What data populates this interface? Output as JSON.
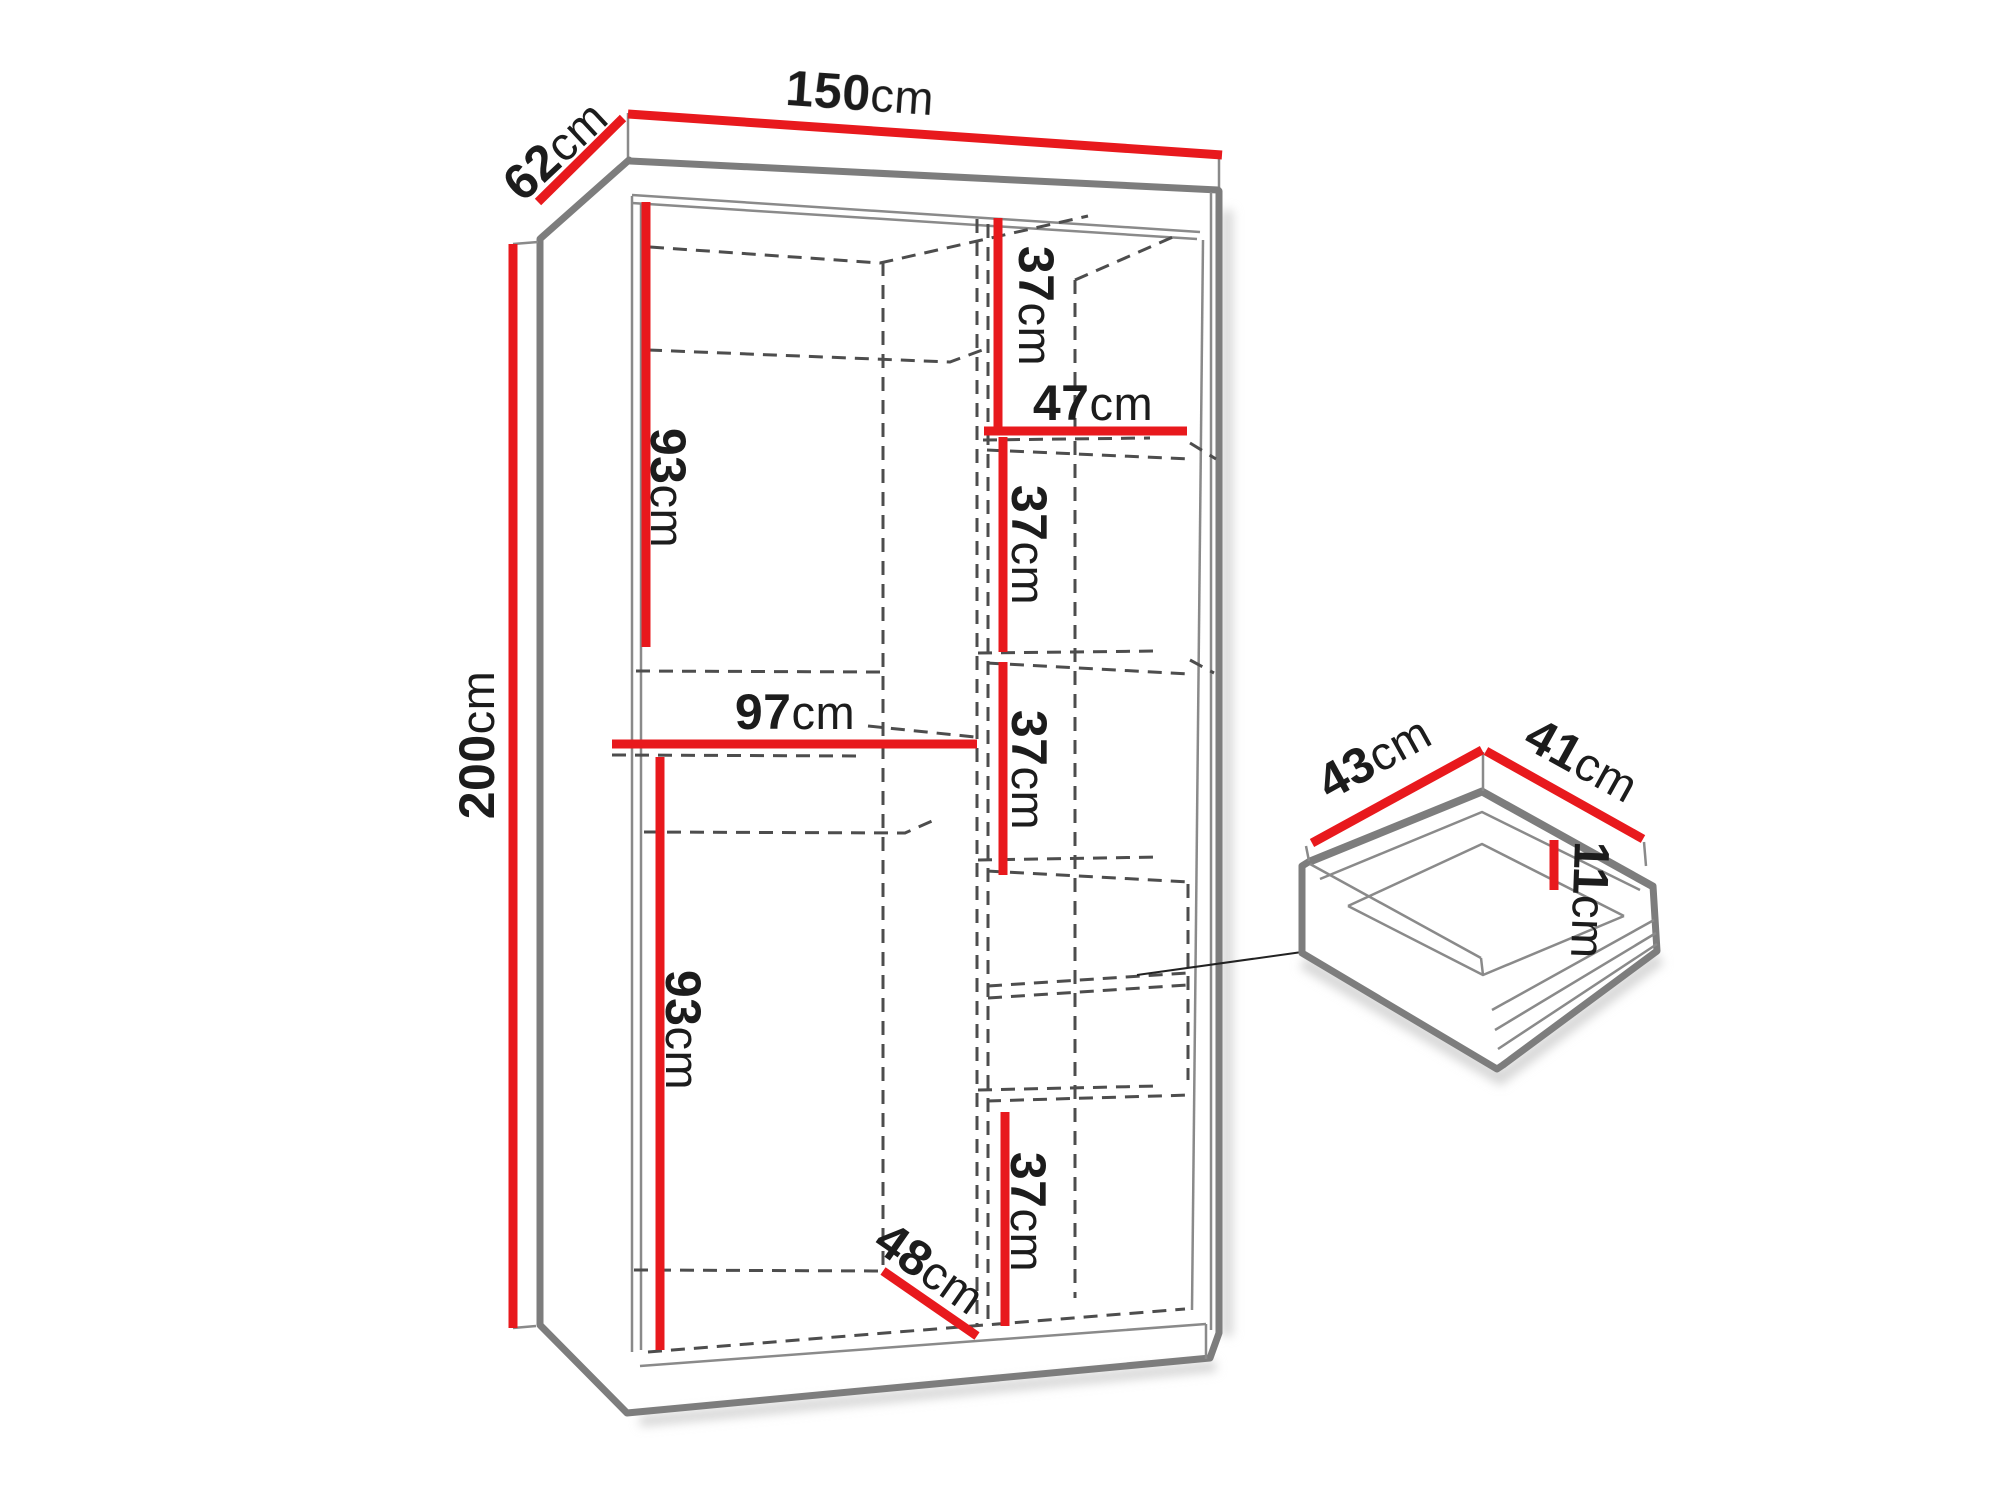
{
  "page": {
    "type": "wardrobe-dimension-diagram",
    "background": "#ffffff"
  },
  "colors": {
    "dimension_line": "#e8191d",
    "outline": "#7d7d7d",
    "hidden_line": "#4d4d4d",
    "label_text": "#1c1c1c"
  },
  "labels": {
    "width": {
      "value": "150",
      "unit": "cm"
    },
    "depth": {
      "value": "62",
      "unit": "cm"
    },
    "height": {
      "value": "200",
      "unit": "cm"
    },
    "upper_hanging_height": {
      "value": "93",
      "unit": "cm"
    },
    "left_shelf_width": {
      "value": "97",
      "unit": "cm"
    },
    "lower_hanging_height": {
      "value": "93",
      "unit": "cm"
    },
    "interior_depth": {
      "value": "48",
      "unit": "cm"
    },
    "right_gap_1": {
      "value": "37",
      "unit": "cm"
    },
    "right_shelf_width": {
      "value": "47",
      "unit": "cm"
    },
    "right_gap_2": {
      "value": "37",
      "unit": "cm"
    },
    "right_gap_3": {
      "value": "37",
      "unit": "cm"
    },
    "right_gap_4": {
      "value": "37",
      "unit": "cm"
    },
    "drawer_depth": {
      "value": "43",
      "unit": "cm"
    },
    "drawer_width": {
      "value": "41",
      "unit": "cm"
    },
    "drawer_height": {
      "value": "11",
      "unit": "cm"
    }
  }
}
